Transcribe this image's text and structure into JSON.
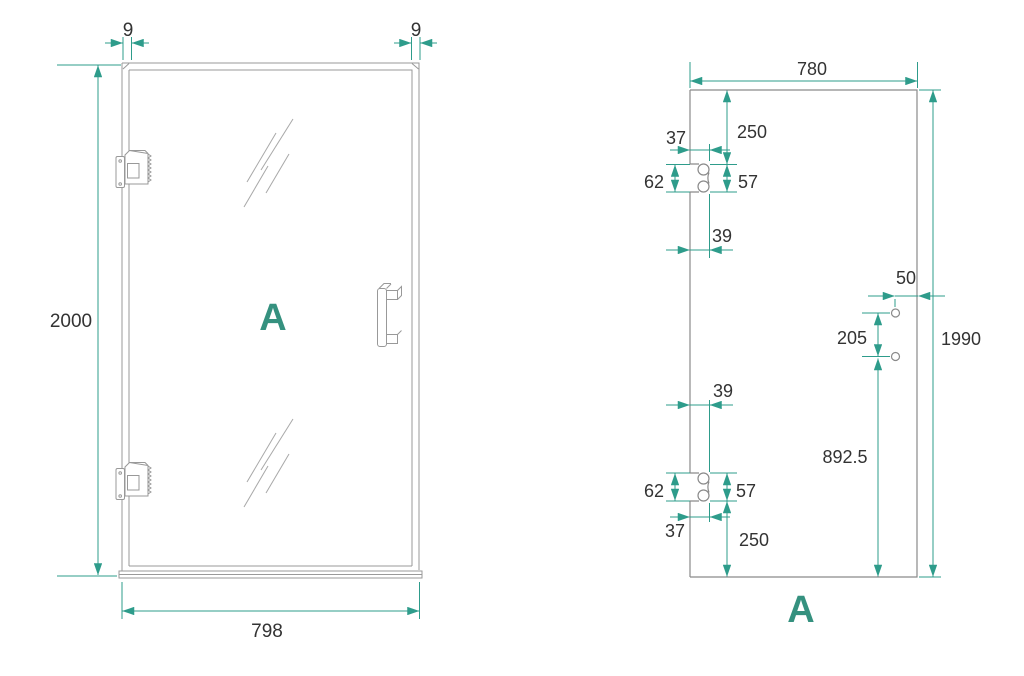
{
  "drawing": {
    "left_view": {
      "label": "A",
      "dims": {
        "top_left_offset": "9",
        "top_right_offset": "9",
        "height": "2000",
        "width": "798"
      }
    },
    "right_view": {
      "label": "A",
      "dims": {
        "width": "780",
        "height": "1990",
        "top_to_hinge": "250",
        "hinge_depth_top": "37",
        "hinge_outer_top": "62",
        "hinge_span_top": "57",
        "edge_to_hole_top": "39",
        "hole_edge_offset": "50",
        "hole_spacing": "205",
        "hole_to_bottom": "892.5",
        "edge_to_hole_bottom": "39",
        "hinge_outer_bottom": "62",
        "hinge_span_bottom": "57",
        "hinge_depth_bottom": "37",
        "bottom_to_hinge": "250"
      }
    },
    "colors": {
      "accent": "#2E9C8B",
      "label": "#35917F",
      "line": "#999999",
      "text": "#333333"
    }
  }
}
